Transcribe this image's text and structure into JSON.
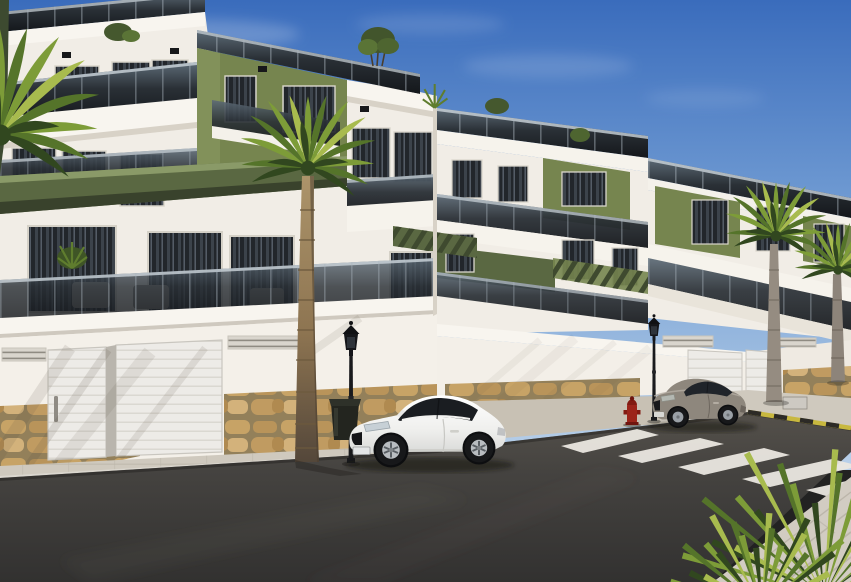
{
  "scene": {
    "type": "architectural-render",
    "description": "New-build Mediterranean apartment complex: white three-storey blocks with olive-green accent panels and glass balcony railings, street-level garage doors over a natural stone base, palm trees, two parked coupes, a zebra crosswalk and street furniture under a clear blue sky.",
    "objects": [
      {
        "label": "apartment-building-left",
        "notes": "three floors, olive green tower panel, glass balustrades, rooftop terrace with plants"
      },
      {
        "label": "apartment-building-middle",
        "notes": "receding block with green facade panels and pergolas"
      },
      {
        "label": "apartment-building-right",
        "notes": "furthest block, green panels, terraces"
      },
      {
        "label": "garage-doors",
        "count": 4
      },
      {
        "label": "stone-base-wall"
      },
      {
        "label": "palm-trees",
        "count": 5
      },
      {
        "label": "white-coupe-car"
      },
      {
        "label": "gray-coupe-car"
      },
      {
        "label": "street-lamp-with-litter-bin"
      },
      {
        "label": "street-lamp-right"
      },
      {
        "label": "fire-hydrant",
        "color": "red"
      },
      {
        "label": "zebra-crosswalk",
        "stripes": 5
      },
      {
        "label": "yellow-black-curb-marking"
      },
      {
        "label": "sidewalk-pavers"
      },
      {
        "label": "asphalt-road"
      },
      {
        "label": "sky-with-faint-clouds"
      }
    ]
  },
  "palette": {
    "sky_top": "#3a6cbc",
    "sky_mid": "#78a2d6",
    "sky_low": "#bad1ea",
    "cloud": "#ffffff",
    "wall": "#f1ede6",
    "wall_bright": "#f8f5ef",
    "wall_shade": "#d8d2c7",
    "glass": "#16191d",
    "rail_top": "#5d6b77",
    "rail_bot": "#14171b",
    "rail_line": "#cdd6dc",
    "olive": "#76854f",
    "olive_dark": "#4e5a39",
    "olive_slat": "#3f4a2f",
    "frame": "#dad6cc",
    "stone_mortar": "#93805a",
    "stone_a": "#c7a366",
    "stone_b": "#b9945a",
    "stone_c": "#d3b27b",
    "stone_d": "#c09b61",
    "door": "#edebe7",
    "door_line": "#d6d3cc",
    "sidewalk": "#cfc9be",
    "apron": "#c8c1b4",
    "paver_line": "#b3ada1",
    "road_top": "#55514b",
    "road_mid": "#454340",
    "road_bot": "#323130",
    "stripe": "#eae7e0",
    "curb_yellow": "#c8b83f",
    "curb_black": "#2c2a26",
    "palm_1": "#31471f",
    "palm_2": "#55742a",
    "palm_3": "#7d9c38",
    "palm_4": "#a8bb4e",
    "trunk": "#ac946a",
    "trunk_dark": "#5f4f38",
    "trunk_gray": "#958c81",
    "car_white": "#f2f2f0",
    "car_glass": "#1a1d21",
    "car_gray": "#8e877d",
    "rim": "#b9bdc1",
    "tire": "#17181a",
    "lamp": "#191a1d",
    "hydrant": "#9c241a",
    "shadow": "#594f41"
  }
}
